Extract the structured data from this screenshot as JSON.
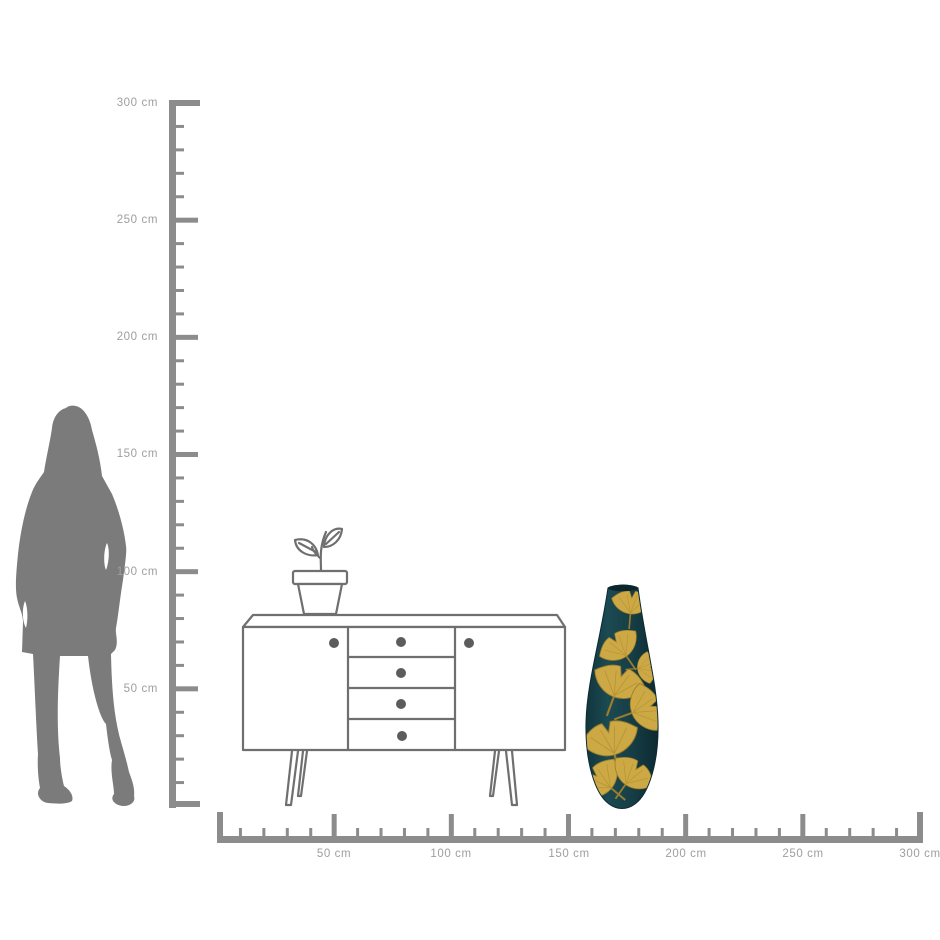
{
  "title": "Product size comparison diagram",
  "rulers": {
    "unit": "cm",
    "vertical": {
      "orientation": "vertical",
      "range_cm": [
        0,
        300
      ],
      "tick_minor_cm": 10,
      "tick_major_cm": 50,
      "labels": [
        "300 cm",
        "250 cm",
        "200 cm",
        "150 cm",
        "100 cm",
        "50 cm"
      ]
    },
    "horizontal": {
      "orientation": "horizontal",
      "range_cm": [
        0,
        300
      ],
      "tick_minor_cm": 10,
      "tick_major_cm": 50,
      "labels": [
        "50 cm",
        "100 cm",
        "150 cm",
        "200 cm",
        "250 cm",
        "300 cm"
      ]
    },
    "colors": {
      "ruler": "#8c8c8c",
      "label_text": "#9e9e9e"
    }
  },
  "figures": {
    "person": {
      "name": "female-silhouette",
      "color": "#7b7b7b"
    },
    "sideboard": {
      "name": "sideboard-line-drawing",
      "line_color": "#6f6f6f",
      "knob_color": "#5c5c5c",
      "drawer_count": 4,
      "door_count": 2
    },
    "plant": {
      "name": "potted-plant-line-drawing",
      "line_color": "#6f6f6f"
    },
    "vase": {
      "name": "ginkgo-floor-vase",
      "body_color_dark": "#0e3139",
      "body_color_mid": "#1c4a52",
      "mouth_color": "#0a262c",
      "leaf_color": "#cda946",
      "leaf_color_light": "#ddbd5c",
      "leaf_vein_color": "#9b7d2a"
    }
  }
}
